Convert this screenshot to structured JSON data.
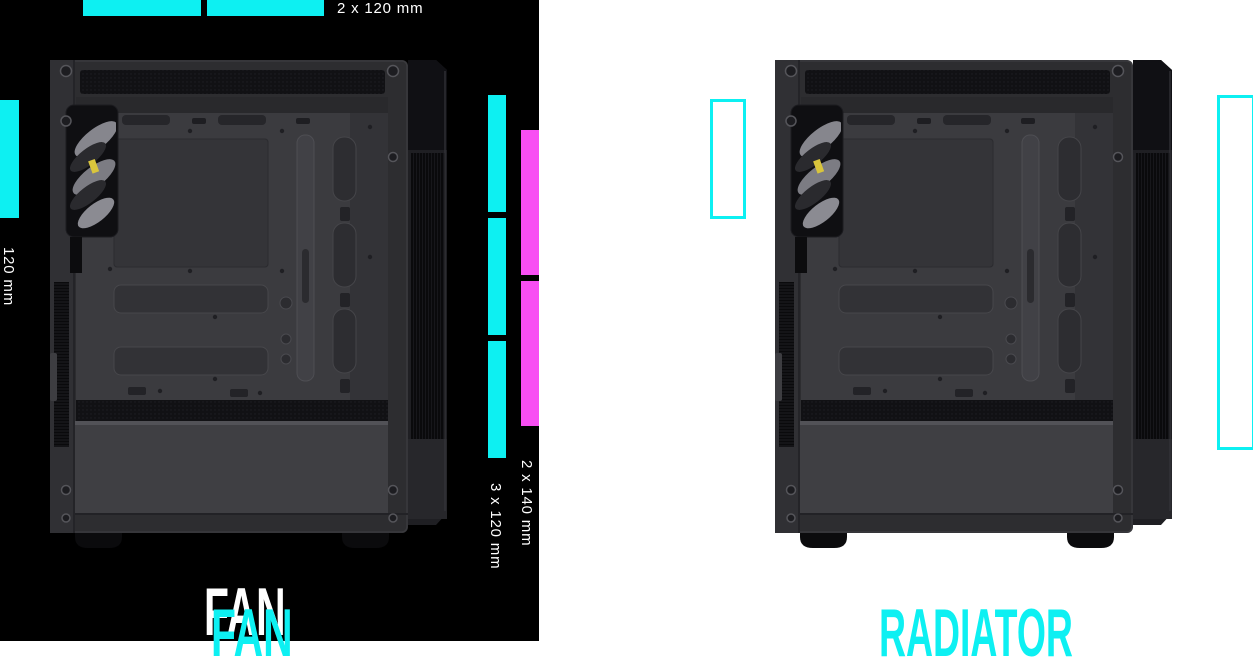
{
  "page": {
    "width": 1253,
    "height": 658
  },
  "colors": {
    "highlight_cyan": "#0df0f2",
    "highlight_magenta": "#f84ef3",
    "label_white": "#ffffff",
    "fan_backdrop_black": "#000000",
    "radiator_backdrop_white": "#ffffff"
  },
  "fan_section": {
    "title": "FAN",
    "top_mount": {
      "label": "2 x 120 mm",
      "segments": 2
    },
    "rear_mount": {
      "label": "120 mm",
      "segments": 1
    },
    "front_mount_140mm": {
      "label": "2 x 140 mm",
      "segments": 2
    },
    "front_mount_120mm": {
      "label": "3 x 120 mm",
      "segments": 3
    }
  },
  "radiator_section": {
    "title": "RADIATOR",
    "rear_slots": 1,
    "front_slots": 1
  },
  "illustration": {
    "name": "pc-case-side-panel-open"
  }
}
